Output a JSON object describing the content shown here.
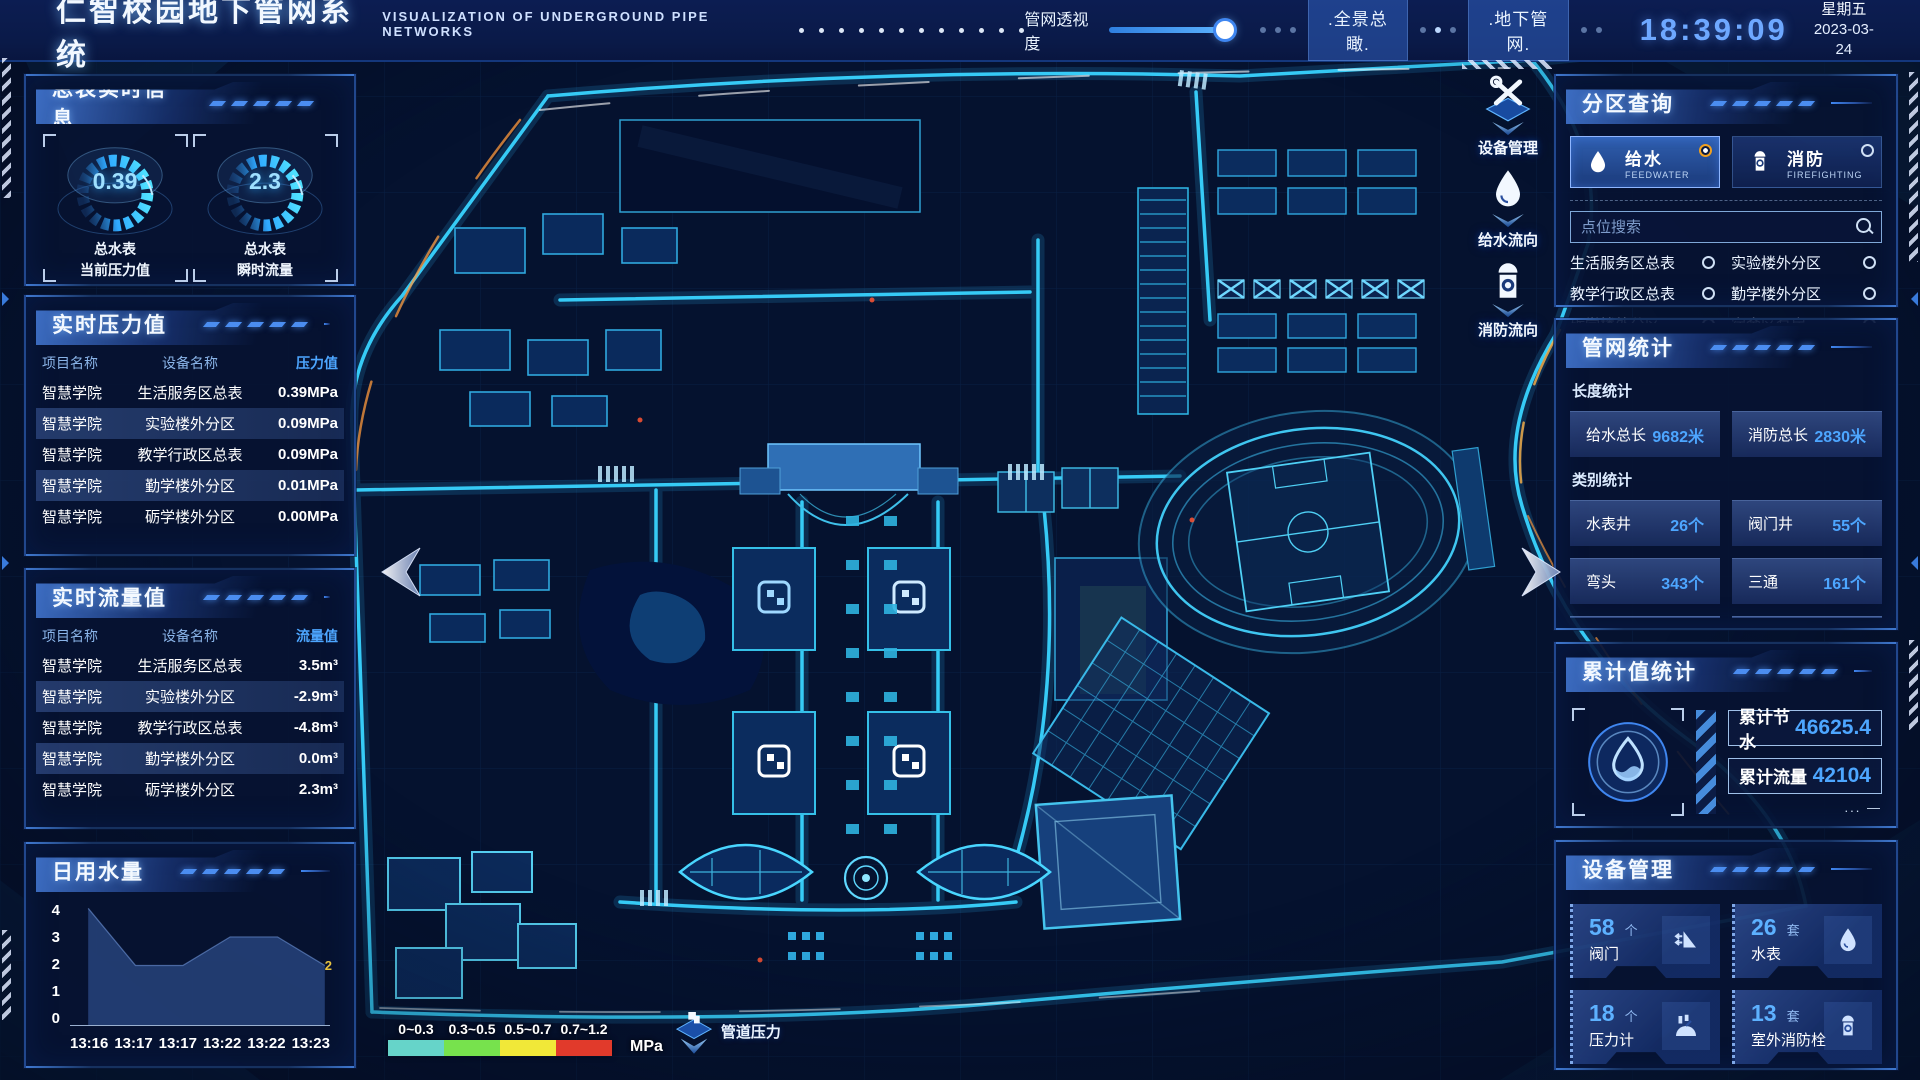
{
  "header": {
    "title": "仁智校园地下管网系统",
    "subtitle": "VISUALIZATION OF UNDERGROUND PIPE NETWORKS",
    "opacity_label": "管网透视度",
    "btn_overview": ".全景总瞰.",
    "btn_underground": ".地下管网.",
    "clock": "18:39:09",
    "weekday": "星期五",
    "date": "2023-03-24"
  },
  "meters": {
    "title": "总表实时信息",
    "gauges": [
      {
        "value": "0.39",
        "line1": "总水表",
        "line2": "当前压力值"
      },
      {
        "value": "2.3",
        "line1": "总水表",
        "line2": "瞬时流量"
      }
    ]
  },
  "pressure": {
    "title": "实时压力值",
    "headers": [
      "项目名称",
      "设备名称",
      "压力值"
    ],
    "rows": [
      {
        "project": "智慧学院",
        "device": "生活服务区总表",
        "value": "0.39MPa"
      },
      {
        "project": "智慧学院",
        "device": "实验楼外分区",
        "value": "0.09MPa"
      },
      {
        "project": "智慧学院",
        "device": "教学行政区总表",
        "value": "0.09MPa"
      },
      {
        "project": "智慧学院",
        "device": "勤学楼外分区",
        "value": "0.01MPa"
      },
      {
        "project": "智慧学院",
        "device": "砺学楼外分区",
        "value": "0.00MPa"
      }
    ]
  },
  "flow": {
    "title": "实时流量值",
    "headers": [
      "项目名称",
      "设备名称",
      "流量值"
    ],
    "rows": [
      {
        "project": "智慧学院",
        "device": "生活服务区总表",
        "value": "3.5m³"
      },
      {
        "project": "智慧学院",
        "device": "实验楼外分区",
        "value": "-2.9m³"
      },
      {
        "project": "智慧学院",
        "device": "教学行政区总表",
        "value": "-4.8m³"
      },
      {
        "project": "智慧学院",
        "device": "勤学楼外分区",
        "value": "0.0m³"
      },
      {
        "project": "智慧学院",
        "device": "砺学楼外分区",
        "value": "2.3m³"
      }
    ]
  },
  "daily": {
    "title": "日用水量"
  },
  "chart_data": {
    "type": "area",
    "title": "日用水量",
    "x": [
      "13:16",
      "13:17",
      "13:17",
      "13:22",
      "13:22",
      "13:23"
    ],
    "values": [
      4,
      2,
      2,
      3,
      3,
      2
    ],
    "yticks": [
      "4",
      "3",
      "2",
      "1",
      "0"
    ],
    "ylim": [
      0,
      4
    ],
    "end_label": "2",
    "grid": false,
    "area_color": "#2b4a86"
  },
  "zone": {
    "title": "分区查询",
    "tabs": [
      {
        "label": "给水",
        "en": "FEEDWATER",
        "selected": true
      },
      {
        "label": "消防",
        "en": "FIREFIGHTING",
        "selected": false
      }
    ],
    "search_placeholder": "点位搜索",
    "points": [
      "生活服务区总表",
      "实验楼外分区",
      "教学行政区总表",
      "勤学楼外分区",
      "砺学楼外分区",
      "宿舍区泵房"
    ]
  },
  "stats": {
    "title": "管网统计",
    "length_title": "长度统计",
    "lengths": [
      {
        "label": "给水总长",
        "value": "9682米"
      },
      {
        "label": "消防总长",
        "value": "2830米"
      }
    ],
    "category_title": "类别统计",
    "categories": [
      {
        "label": "水表井",
        "value": "26个"
      },
      {
        "label": "阀门井",
        "value": "55个"
      },
      {
        "label": "弯头",
        "value": "343个"
      },
      {
        "label": "三通",
        "value": "161个"
      }
    ]
  },
  "totals": {
    "title": "累计值统计",
    "rows": [
      {
        "label": "累计节水",
        "value": "46625.4"
      },
      {
        "label": "累计流量",
        "value": "42104"
      }
    ]
  },
  "devices": {
    "title": "设备管理",
    "items": [
      {
        "count": "58",
        "unit": "个",
        "label": "阀门",
        "icon": "valve-icon"
      },
      {
        "count": "26",
        "unit": "套",
        "label": "水表",
        "icon": "water-meter-icon"
      },
      {
        "count": "18",
        "unit": "个",
        "label": "压力计",
        "icon": "pressure-gauge-icon"
      },
      {
        "count": "13",
        "unit": "套",
        "label": "室外消防栓",
        "icon": "hydrant-icon"
      }
    ]
  },
  "mapui": {
    "tools": [
      "设备管理",
      "给水流向",
      "消防流向"
    ],
    "legend": {
      "ranges": [
        {
          "label": "0~0.3",
          "color": "#66d4c9"
        },
        {
          "label": "0.3~0.5",
          "color": "#77e24d"
        },
        {
          "label": "0.5~0.7",
          "color": "#f1e838"
        },
        {
          "label": "0.7~1.2",
          "color": "#e13a2b"
        }
      ],
      "unit": "MPa",
      "marker_label": "管道压力"
    }
  },
  "colors": {
    "accent": "#35d8ff",
    "value_blue": "#4da6ff",
    "panel_border": "#2a5fae"
  }
}
